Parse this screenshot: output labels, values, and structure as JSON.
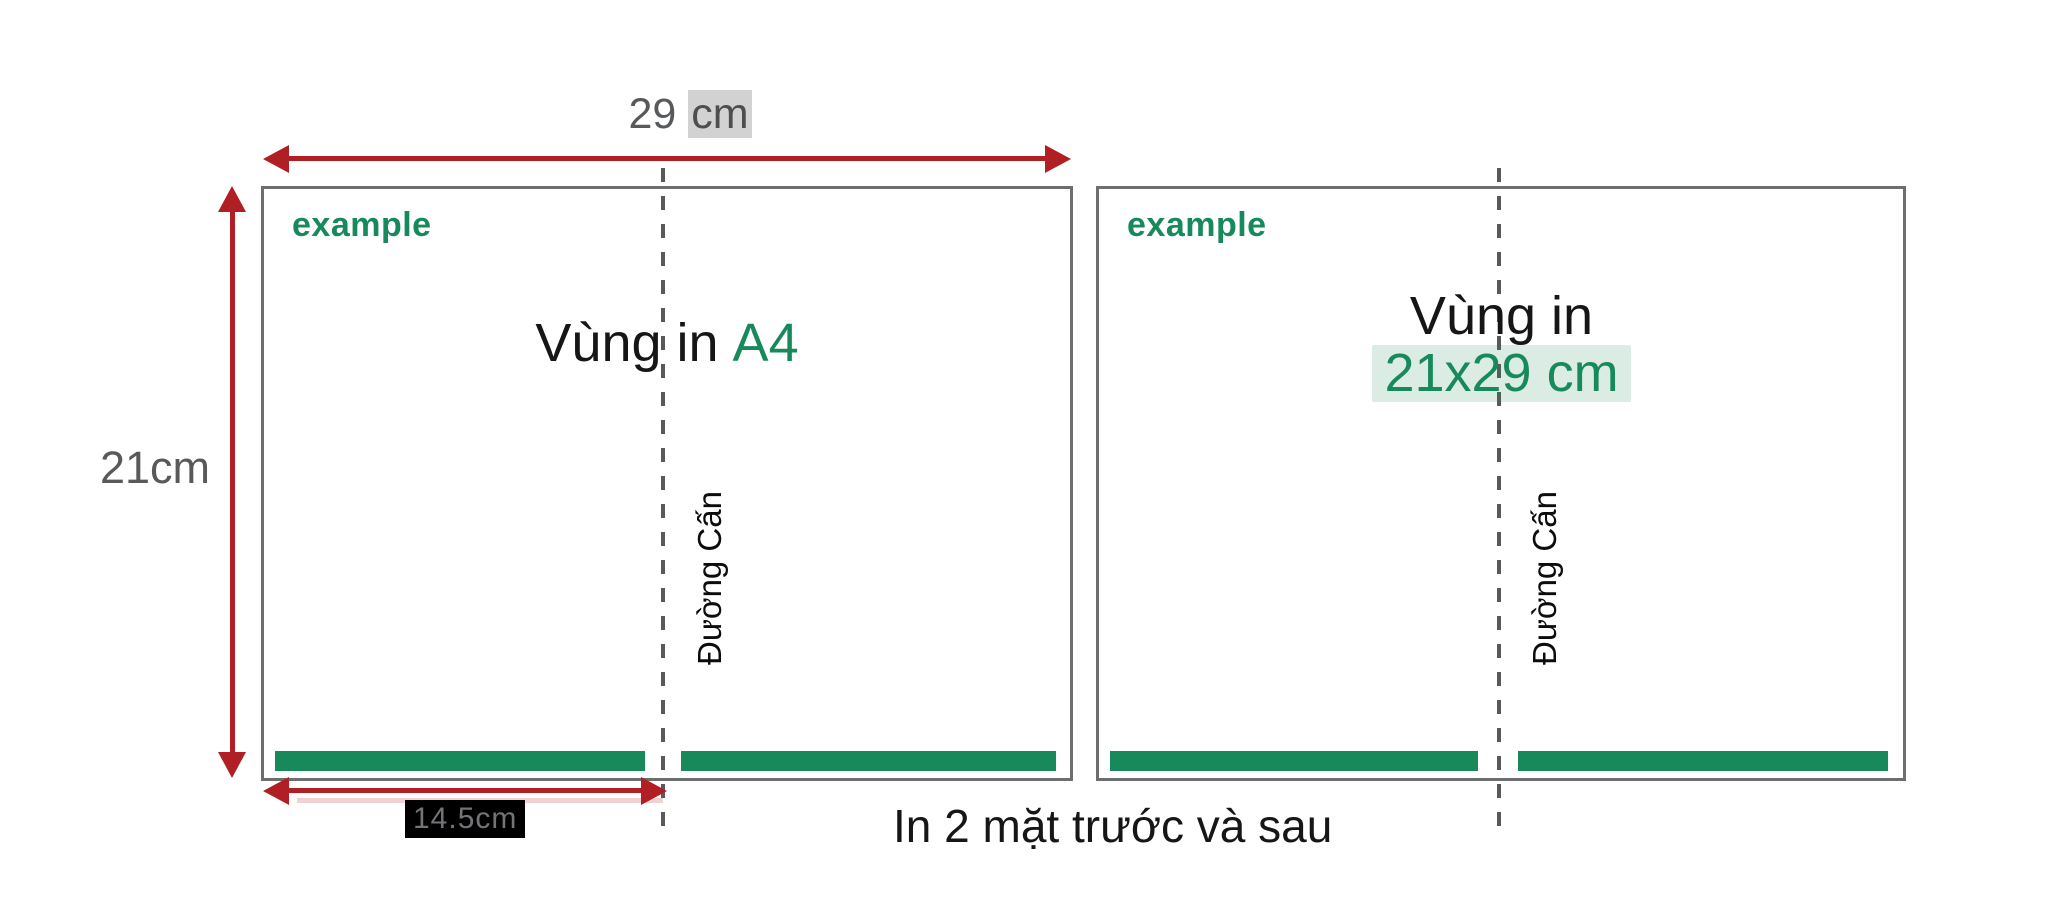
{
  "colors": {
    "arrow_red": "#b01f24",
    "arrow_red_shadow": "#f0d2d4",
    "brand_green": "#17895a",
    "green_highlight_bg": "rgba(23,137,90,0.16)",
    "sheet_border_gray": "#6d6e70",
    "fold_dash_gray": "#58595b",
    "dimension_text_gray": "#58595b",
    "text_black": "#161616",
    "half_label_bg": "#000000"
  },
  "top_dimension": {
    "value": "29",
    "unit": "cm"
  },
  "left_dimension": {
    "label": "21cm"
  },
  "bottom_dimension": {
    "label": "14.5cm"
  },
  "sheets": [
    {
      "brand": "example",
      "print_area_title": "Vùng in",
      "print_area_highlight": "A4",
      "fold_line_label": "Đường Cấn"
    },
    {
      "brand": "example",
      "print_area_title": "Vùng in",
      "print_area_highlight": "21x29 cm",
      "fold_line_label": "Đường Cấn"
    }
  ],
  "caption": "In 2 mặt trước và sau"
}
